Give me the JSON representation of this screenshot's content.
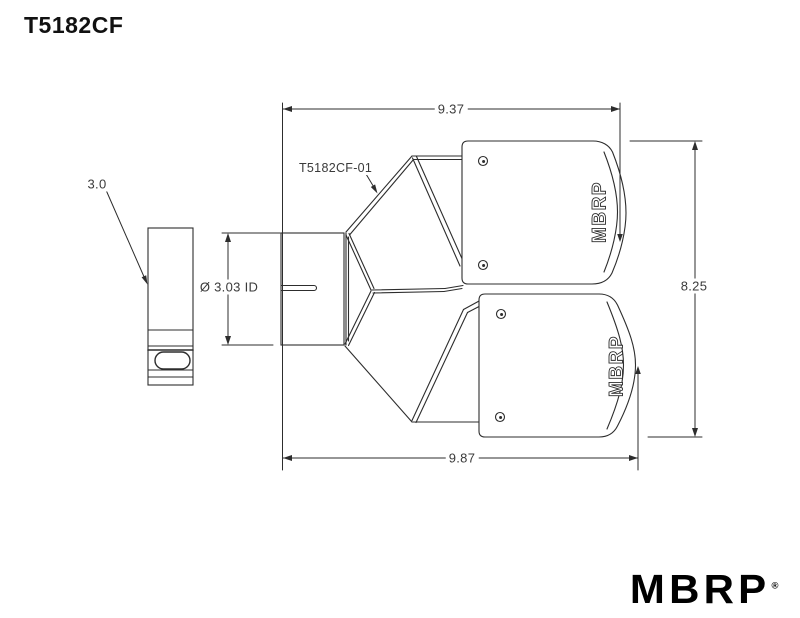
{
  "title": "T5182CF",
  "drawing": {
    "part_label": "T5182CF-01",
    "dimensions": {
      "top_width": "9.37",
      "bottom_width": "9.87",
      "overall_height": "8.25",
      "inlet_inner_diameter": "Ø 3.03 ID",
      "inlet_size": "3.0"
    },
    "tip_engraving": "MBRP"
  },
  "logo": {
    "brand": "MBRP",
    "registered_mark": "®"
  },
  "colors": {
    "line": "#2d2d2d",
    "background": "#ffffff"
  }
}
